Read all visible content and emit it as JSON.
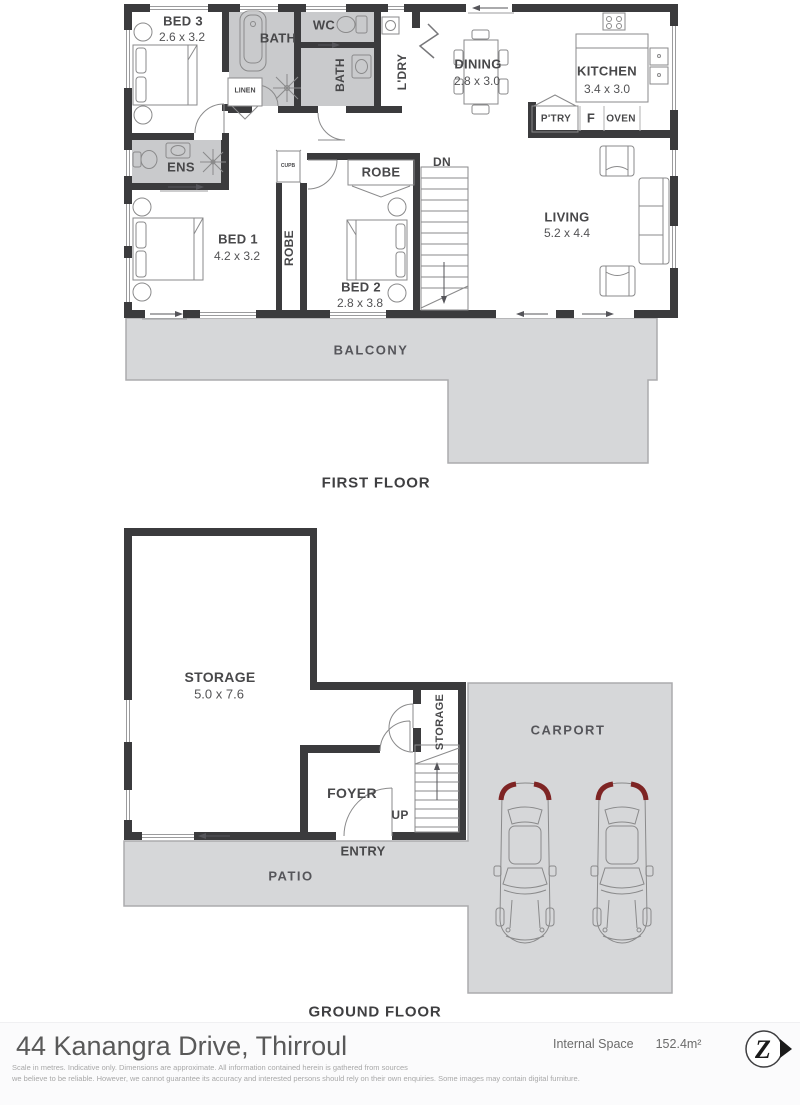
{
  "first_floor": {
    "caption": "FIRST FLOOR",
    "bed3_name": "BED 3",
    "bed3_dims": "2.6 x 3.2",
    "bath1_name": "BATH",
    "wc_name": "WC",
    "bath2_name": "BATH",
    "ldry_name": "L'DRY",
    "linen_name": "LINEN",
    "cupb_name": "CUPB",
    "ens_name": "ENS",
    "dining_name": "DINING",
    "dining_dims": "2.8 x 3.0",
    "kitchen_name": "KITCHEN",
    "kitchen_dims": "3.4 x 3.0",
    "ptry_name": "P'TRY",
    "fridge_name": "F",
    "oven_name": "OVEN",
    "dn_name": "DN",
    "living_name": "LIVING",
    "living_dims": "5.2 x 4.4",
    "bed1_name": "BED 1",
    "bed1_dims": "4.2 x 3.2",
    "robe_hall_name": "ROBE",
    "robe_bed2_name": "ROBE",
    "bed2_name": "BED 2",
    "bed2_dims": "2.8 x 3.8",
    "balcony_name": "BALCONY"
  },
  "ground_floor": {
    "caption": "GROUND FLOOR",
    "storage_name": "STORAGE",
    "storage_dims": "5.0 x 7.6",
    "storage2_name": "STORAGE",
    "foyer_name": "FOYER",
    "up_name": "UP",
    "entry_name": "ENTRY",
    "patio_name": "PATIO",
    "carport_name": "CARPORT"
  },
  "footer": {
    "address": "44 Kanangra Drive, Thirroul",
    "internal_space_label": "Internal Space",
    "internal_space_value": "152.4m²",
    "logo_letter": "Z",
    "disclaimer_line1": "Scale in metres. Indicative only. Dimensions are approximate. All information contained herein is gathered from sources",
    "disclaimer_line2": "we believe to be reliable. However, we cannot guarantee its accuracy and interested persons should rely on their own enquiries. Some images may contain digital furniture."
  },
  "colors": {
    "wall": "#3b3b3d",
    "wet_area": "#c9cacc",
    "outdoor_fill": "#d6d7d9",
    "outdoor_stroke": "#abacae",
    "taillight_red": "#7e2424"
  }
}
